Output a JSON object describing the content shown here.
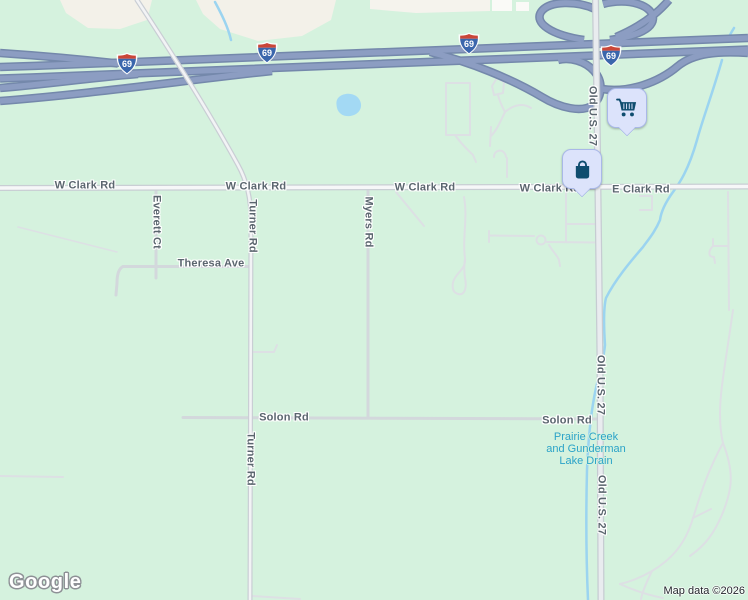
{
  "map": {
    "type": "google-maps-roadmap",
    "watermark": "Google",
    "attribution": "Map data ©2026",
    "interstate_shield": "69",
    "road_labels": {
      "w_clark_rd": "W Clark Rd",
      "e_clark_rd": "E Clark Rd",
      "turner_rd": "Turner Rd",
      "myers_rd": "Myers Rd",
      "everett_ct": "Everett Ct",
      "theresa_ave": "Theresa Ave",
      "solon_rd": "Solon Rd",
      "old_us_27": "Old U.S. 27"
    },
    "water_label": {
      "line1": "Prairie Creek",
      "line2": "and Gunderman",
      "line3": "Lake Drain"
    },
    "markers": {
      "cart_icon": "shopping-cart-icon",
      "bag_icon": "shopping-bag-icon"
    },
    "colors": {
      "land_green": "#d5f2de",
      "land_beige": "#f3f1e9",
      "water": "#9bd4f0",
      "freeway_fill": "#8c9dc2",
      "freeway_casing": "#7488ab",
      "road_fill": "#f6f7f8",
      "road_casing": "#c9ced4",
      "label_text": "#5b666f",
      "water_text": "#2ba3c8",
      "marker_bg": "#dce3fb",
      "marker_icon": "#0f4d6f",
      "shield_blue": "#3a66ac",
      "shield_red": "#ca4638"
    }
  }
}
